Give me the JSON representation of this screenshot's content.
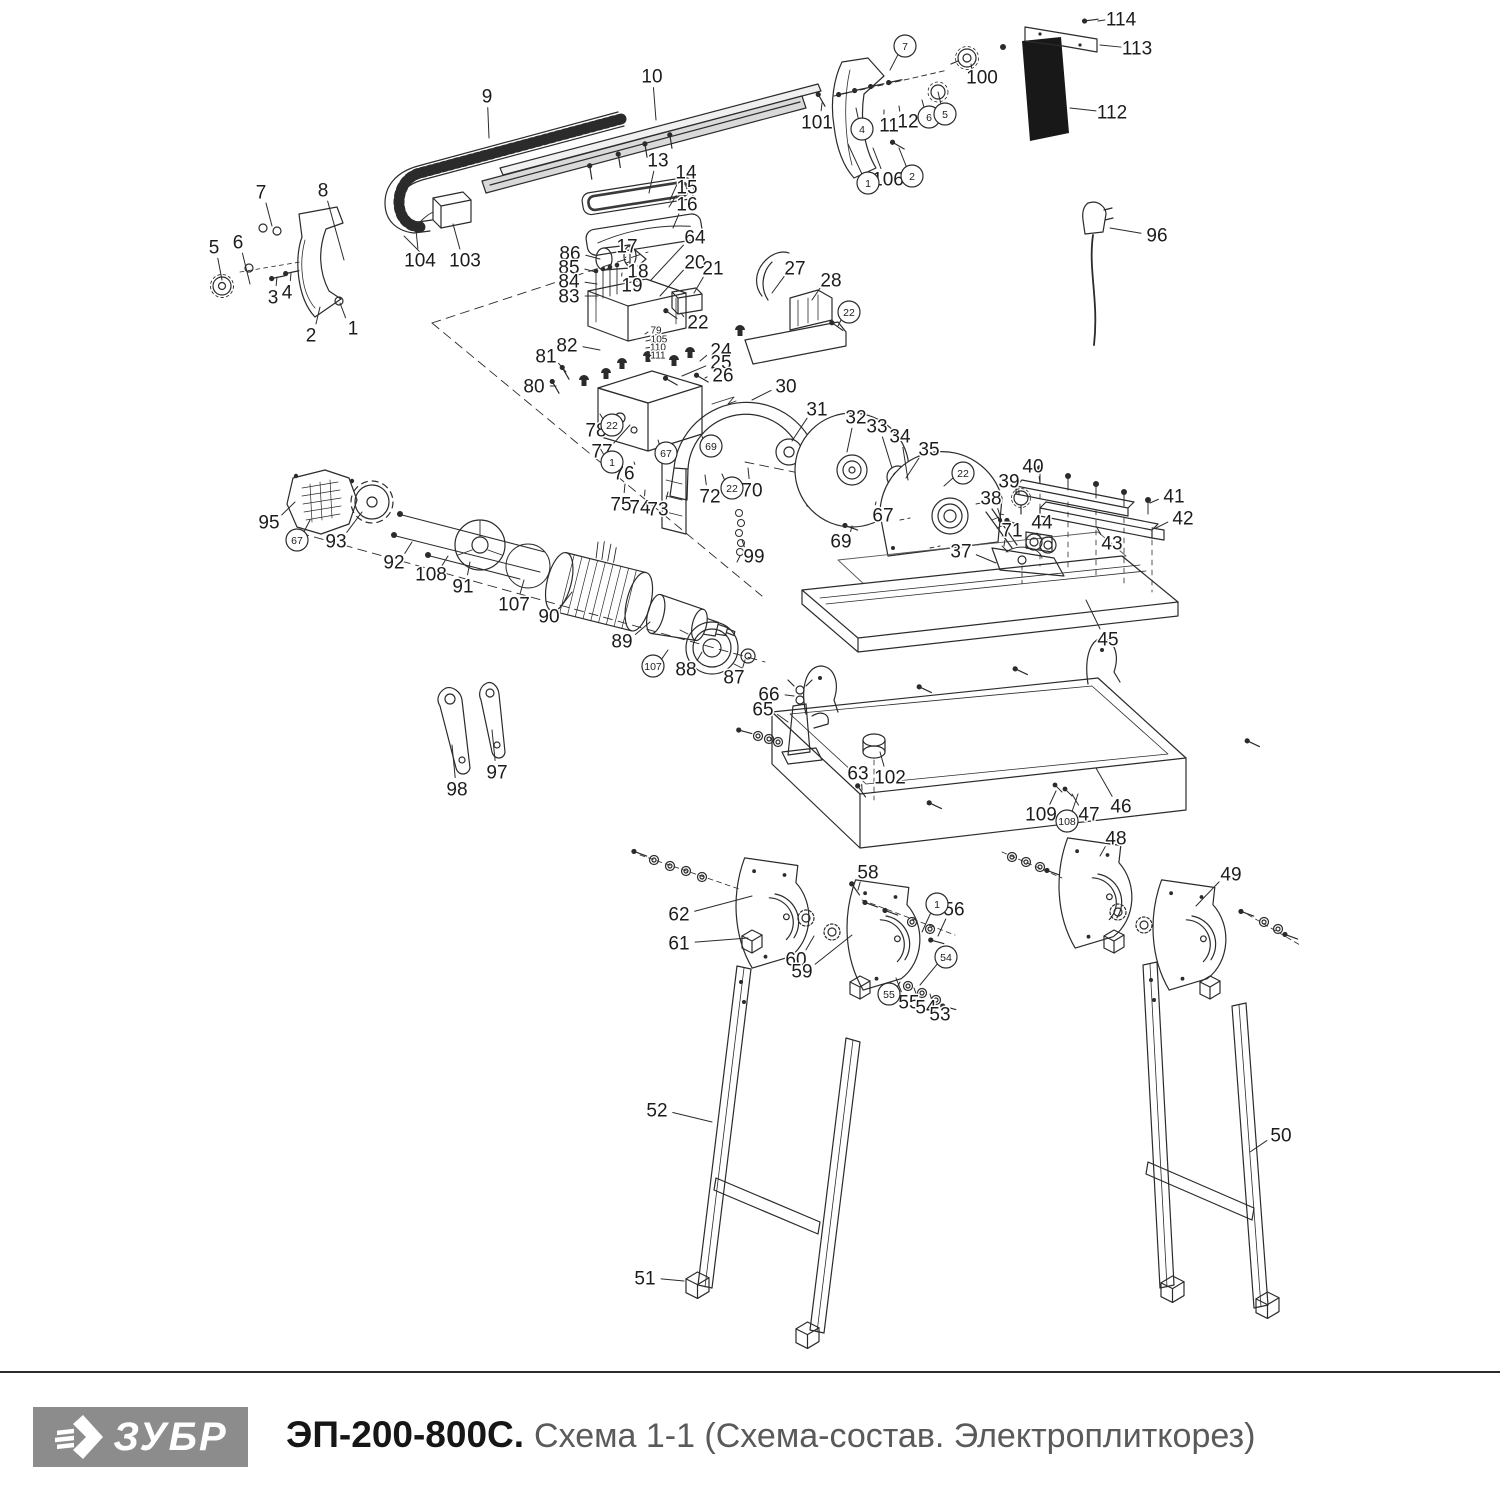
{
  "footer": {
    "brand": "ЗУБР",
    "model": "ЭП-200-800С.",
    "subtitle": "Схема 1-1 (Схема-состав. Электроплиткорез)"
  },
  "colors": {
    "line": "#2b2b2b",
    "label": "#1c1c1c",
    "plate_fill": "#161616",
    "rail_fill": "#d9d9d9",
    "logo_bg": "#8c8c8c",
    "separator": "#2b2b2b",
    "title_gray": "#5a5a5a"
  },
  "callouts": [
    {
      "n": "7",
      "x": 261,
      "y": 192,
      "tx": 272,
      "ty": 226
    },
    {
      "n": "8",
      "x": 323,
      "y": 190,
      "tx": 344,
      "ty": 260
    },
    {
      "n": "5",
      "x": 214,
      "y": 247,
      "tx": 222,
      "ty": 280
    },
    {
      "n": "6",
      "x": 238,
      "y": 242,
      "tx": 250,
      "ty": 284
    },
    {
      "n": "3",
      "x": 273,
      "y": 297,
      "tx": 277,
      "ty": 277
    },
    {
      "n": "4",
      "x": 287,
      "y": 292,
      "tx": 291,
      "ty": 273
    },
    {
      "n": "2",
      "x": 311,
      "y": 335,
      "tx": 320,
      "ty": 307
    },
    {
      "n": "1",
      "x": 353,
      "y": 328,
      "tx": 340,
      "ty": 303
    },
    {
      "n": "9",
      "x": 487,
      "y": 96,
      "tx": 489,
      "ty": 138
    },
    {
      "n": "104",
      "x": 420,
      "y": 260,
      "tx": 416,
      "ty": 230
    },
    {
      "n": "103",
      "x": 465,
      "y": 260,
      "tx": 453,
      "ty": 224
    },
    {
      "n": "10",
      "x": 652,
      "y": 76,
      "tx": 656,
      "ty": 120
    },
    {
      "n": "13",
      "x": 658,
      "y": 160,
      "tx": 649,
      "ty": 193
    },
    {
      "n": "14",
      "x": 686,
      "y": 172,
      "tx": 670,
      "ty": 200
    },
    {
      "n": "15",
      "x": 687,
      "y": 187,
      "tx": 669,
      "ty": 207
    },
    {
      "n": "16",
      "x": 687,
      "y": 204,
      "tx": 673,
      "ty": 228
    },
    {
      "n": "64",
      "x": 695,
      "y": 237,
      "tx": 651,
      "ty": 280
    },
    {
      "n": "20",
      "x": 695,
      "y": 262,
      "tx": 660,
      "ty": 296
    },
    {
      "n": "21",
      "x": 713,
      "y": 268,
      "tx": 694,
      "ty": 293
    },
    {
      "n": "22",
      "x": 698,
      "y": 322,
      "tx": 681,
      "ty": 313
    },
    {
      "n": "86",
      "x": 570,
      "y": 253,
      "tx": 600,
      "ty": 259
    },
    {
      "n": "85",
      "x": 569,
      "y": 267,
      "tx": 596,
      "ty": 272
    },
    {
      "n": "84",
      "x": 569,
      "y": 281,
      "tx": 597,
      "ty": 284
    },
    {
      "n": "83",
      "x": 569,
      "y": 296,
      "tx": 598,
      "ty": 296
    },
    {
      "n": "17",
      "x": 627,
      "y": 246,
      "tx": 626,
      "ty": 257
    },
    {
      "n": "18",
      "x": 638,
      "y": 271,
      "tx": 629,
      "ty": 262
    },
    {
      "n": "19",
      "x": 632,
      "y": 285,
      "tx": 622,
      "ty": 273
    },
    {
      "n": "82",
      "x": 567,
      "y": 345,
      "tx": 600,
      "ty": 350
    },
    {
      "n": "79",
      "x": 656,
      "y": 330,
      "tx": 645,
      "ty": 334,
      "s": 10
    },
    {
      "n": "105",
      "x": 659,
      "y": 339,
      "tx": 646,
      "ty": 341,
      "s": 10
    },
    {
      "n": "110",
      "x": 658,
      "y": 347,
      "tx": 646,
      "ty": 348,
      "s": 10
    },
    {
      "n": "111",
      "x": 658,
      "y": 355,
      "tx": 646,
      "ty": 355,
      "s": 10
    },
    {
      "n": "24",
      "x": 721,
      "y": 350,
      "tx": 700,
      "ty": 361
    },
    {
      "n": "25",
      "x": 721,
      "y": 362,
      "tx": 682,
      "ty": 376
    },
    {
      "n": "26",
      "x": 723,
      "y": 375,
      "tx": 705,
      "ty": 378
    },
    {
      "n": "27",
      "x": 795,
      "y": 268,
      "tx": 772,
      "ty": 293
    },
    {
      "n": "28",
      "x": 831,
      "y": 280,
      "tx": 812,
      "ty": 300
    },
    {
      "n": "101",
      "x": 817,
      "y": 122,
      "tx": 822,
      "ty": 103
    },
    {
      "n": "11",
      "x": 889,
      "y": 125,
      "tx": 884,
      "ty": 110
    },
    {
      "n": "12",
      "x": 908,
      "y": 121,
      "tx": 899,
      "ty": 106
    },
    {
      "n": "100",
      "x": 982,
      "y": 77,
      "tx": 971,
      "ty": 64
    },
    {
      "n": "106",
      "x": 888,
      "y": 179,
      "tx": 873,
      "ty": 148
    },
    {
      "n": "114",
      "x": 1121,
      "y": 19,
      "tx": 1098,
      "ty": 21
    },
    {
      "n": "113",
      "x": 1137,
      "y": 48,
      "tx": 1100,
      "ty": 45
    },
    {
      "n": "112",
      "x": 1112,
      "y": 112,
      "tx": 1070,
      "ty": 108
    },
    {
      "n": "96",
      "x": 1157,
      "y": 235,
      "tx": 1110,
      "ty": 228
    },
    {
      "n": "81",
      "x": 546,
      "y": 356,
      "tx": 566,
      "ty": 372
    },
    {
      "n": "80",
      "x": 534,
      "y": 386,
      "tx": 556,
      "ty": 386
    },
    {
      "n": "78",
      "x": 596,
      "y": 430,
      "tx": 612,
      "ty": 414
    },
    {
      "n": "77",
      "x": 602,
      "y": 451,
      "tx": 630,
      "ty": 425
    },
    {
      "n": "76",
      "x": 624,
      "y": 473,
      "tx": 634,
      "ty": 462
    },
    {
      "n": "75",
      "x": 621,
      "y": 504,
      "tx": 625,
      "ty": 484
    },
    {
      "n": "74",
      "x": 640,
      "y": 507,
      "tx": 645,
      "ty": 490
    },
    {
      "n": "73",
      "x": 658,
      "y": 509,
      "tx": 668,
      "ty": 492
    },
    {
      "n": "72",
      "x": 710,
      "y": 496,
      "tx": 705,
      "ty": 475
    },
    {
      "n": "70",
      "x": 752,
      "y": 490,
      "tx": 748,
      "ty": 468
    },
    {
      "n": "30",
      "x": 786,
      "y": 386,
      "tx": 752,
      "ty": 400
    },
    {
      "n": "31",
      "x": 817,
      "y": 409,
      "tx": 792,
      "ty": 441
    },
    {
      "n": "32",
      "x": 856,
      "y": 417,
      "tx": 847,
      "ty": 452
    },
    {
      "n": "33",
      "x": 877,
      "y": 426,
      "tx": 892,
      "ty": 468
    },
    {
      "n": "34",
      "x": 900,
      "y": 436,
      "tx": 908,
      "ty": 480
    },
    {
      "n": "35",
      "x": 929,
      "y": 449,
      "tx": 906,
      "ty": 478
    },
    {
      "n": "69",
      "x": 841,
      "y": 541,
      "tx": 852,
      "ty": 526
    },
    {
      "n": "67",
      "x": 883,
      "y": 515,
      "tx": 876,
      "ty": 502
    },
    {
      "n": "99",
      "x": 754,
      "y": 556,
      "tx": 742,
      "ty": 540
    },
    {
      "n": "37",
      "x": 961,
      "y": 551,
      "tx": 996,
      "ty": 563
    },
    {
      "n": "38",
      "x": 991,
      "y": 498,
      "tx": 1002,
      "ty": 522
    },
    {
      "n": "39",
      "x": 1009,
      "y": 481,
      "tx": 1019,
      "ty": 494
    },
    {
      "n": "40",
      "x": 1033,
      "y": 466,
      "tx": 1040,
      "ty": 483
    },
    {
      "n": "41",
      "x": 1174,
      "y": 496,
      "tx": 1150,
      "ty": 503
    },
    {
      "n": "42",
      "x": 1183,
      "y": 518,
      "tx": 1156,
      "ty": 528
    },
    {
      "n": "43",
      "x": 1112,
      "y": 543,
      "tx": 1096,
      "ty": 526
    },
    {
      "n": "44",
      "x": 1042,
      "y": 522,
      "tx": 1038,
      "ty": 534
    },
    {
      "n": "45",
      "x": 1108,
      "y": 639,
      "tx": 1086,
      "ty": 600
    },
    {
      "n": "71",
      "x": 1012,
      "y": 530,
      "tx": 1004,
      "ty": 546
    },
    {
      "n": "95",
      "x": 269,
      "y": 522,
      "tx": 295,
      "ty": 502
    },
    {
      "n": "93",
      "x": 336,
      "y": 541,
      "tx": 362,
      "ty": 512
    },
    {
      "n": "92",
      "x": 394,
      "y": 562,
      "tx": 412,
      "ty": 542
    },
    {
      "n": "108",
      "x": 431,
      "y": 574,
      "tx": 448,
      "ty": 556
    },
    {
      "n": "91",
      "x": 463,
      "y": 586,
      "tx": 470,
      "ty": 562
    },
    {
      "n": "107",
      "x": 514,
      "y": 604,
      "tx": 524,
      "ty": 580
    },
    {
      "n": "90",
      "x": 549,
      "y": 616,
      "tx": 572,
      "ty": 592
    },
    {
      "n": "89",
      "x": 622,
      "y": 641,
      "tx": 650,
      "ty": 622
    },
    {
      "n": "88",
      "x": 686,
      "y": 669,
      "tx": 702,
      "ty": 652
    },
    {
      "n": "87",
      "x": 734,
      "y": 677,
      "tx": 745,
      "ty": 660
    },
    {
      "n": "98",
      "x": 457,
      "y": 789,
      "tx": 452,
      "ty": 745
    },
    {
      "n": "97",
      "x": 497,
      "y": 772,
      "tx": 492,
      "ty": 730
    },
    {
      "n": "66",
      "x": 769,
      "y": 694,
      "tx": 794,
      "ty": 696
    },
    {
      "n": "65",
      "x": 763,
      "y": 709,
      "tx": 788,
      "ty": 722
    },
    {
      "n": "63",
      "x": 858,
      "y": 773,
      "tx": 862,
      "ty": 790
    },
    {
      "n": "102",
      "x": 890,
      "y": 777,
      "tx": 880,
      "ty": 752
    },
    {
      "n": "109",
      "x": 1041,
      "y": 814,
      "tx": 1056,
      "ty": 791
    },
    {
      "n": "47",
      "x": 1089,
      "y": 814,
      "tx": 1072,
      "ty": 794
    },
    {
      "n": "46",
      "x": 1121,
      "y": 806,
      "tx": 1096,
      "ty": 768
    },
    {
      "n": "48",
      "x": 1116,
      "y": 838,
      "tx": 1100,
      "ty": 856
    },
    {
      "n": "58",
      "x": 868,
      "y": 872,
      "tx": 858,
      "ty": 890
    },
    {
      "n": "62",
      "x": 679,
      "y": 914,
      "tx": 752,
      "ty": 896
    },
    {
      "n": "61",
      "x": 679,
      "y": 943,
      "tx": 748,
      "ty": 938
    },
    {
      "n": "60",
      "x": 796,
      "y": 959,
      "tx": 814,
      "ty": 936
    },
    {
      "n": "59",
      "x": 802,
      "y": 971,
      "tx": 852,
      "ty": 935
    },
    {
      "n": "56",
      "x": 954,
      "y": 909,
      "tx": 938,
      "ty": 936
    },
    {
      "n": "55",
      "x": 909,
      "y": 1002,
      "tx": 896,
      "ty": 978
    },
    {
      "n": "54",
      "x": 926,
      "y": 1007,
      "tx": 914,
      "ty": 988
    },
    {
      "n": "53",
      "x": 940,
      "y": 1014,
      "tx": 930,
      "ty": 994
    },
    {
      "n": "49",
      "x": 1231,
      "y": 874,
      "tx": 1196,
      "ty": 906
    },
    {
      "n": "52",
      "x": 657,
      "y": 1110,
      "tx": 712,
      "ty": 1122
    },
    {
      "n": "51",
      "x": 645,
      "y": 1278,
      "tx": 684,
      "ty": 1281
    },
    {
      "n": "50",
      "x": 1281,
      "y": 1135,
      "tx": 1250,
      "ty": 1152
    }
  ],
  "circled_callouts": [
    {
      "n": "7",
      "x": 905,
      "y": 46,
      "tx": 890,
      "ty": 70
    },
    {
      "n": "4",
      "x": 862,
      "y": 129,
      "tx": 856,
      "ty": 108
    },
    {
      "n": "1",
      "x": 868,
      "y": 183,
      "tx": 848,
      "ty": 144
    },
    {
      "n": "2",
      "x": 912,
      "y": 176,
      "tx": 899,
      "ty": 148
    },
    {
      "n": "6",
      "x": 929,
      "y": 117,
      "tx": 922,
      "ty": 100
    },
    {
      "n": "5",
      "x": 945,
      "y": 114,
      "tx": 938,
      "ty": 92
    },
    {
      "n": "22",
      "x": 849,
      "y": 312,
      "tx": 838,
      "ty": 326
    },
    {
      "n": "22",
      "x": 612,
      "y": 425,
      "tx": 600,
      "ty": 414
    },
    {
      "n": "1",
      "x": 612,
      "y": 462,
      "tx": 600,
      "ty": 448
    },
    {
      "n": "67",
      "x": 666,
      "y": 453,
      "tx": 658,
      "ty": 440
    },
    {
      "n": "69",
      "x": 711,
      "y": 446,
      "tx": 702,
      "ty": 436
    },
    {
      "n": "22",
      "x": 732,
      "y": 488,
      "tx": 722,
      "ty": 474
    },
    {
      "n": "22",
      "x": 963,
      "y": 473,
      "tx": 944,
      "ty": 486
    },
    {
      "n": "67",
      "x": 297,
      "y": 540,
      "tx": 310,
      "ty": 520
    },
    {
      "n": "107",
      "x": 653,
      "y": 666,
      "tx": 668,
      "ty": 650
    },
    {
      "n": "108",
      "x": 1067,
      "y": 821,
      "tx": 1078,
      "ty": 794
    },
    {
      "n": "1",
      "x": 937,
      "y": 904,
      "tx": 922,
      "ty": 932
    },
    {
      "n": "54",
      "x": 946,
      "y": 957,
      "tx": 920,
      "ty": 985
    },
    {
      "n": "55",
      "x": 889,
      "y": 994,
      "tx": 900,
      "ty": 982
    }
  ]
}
